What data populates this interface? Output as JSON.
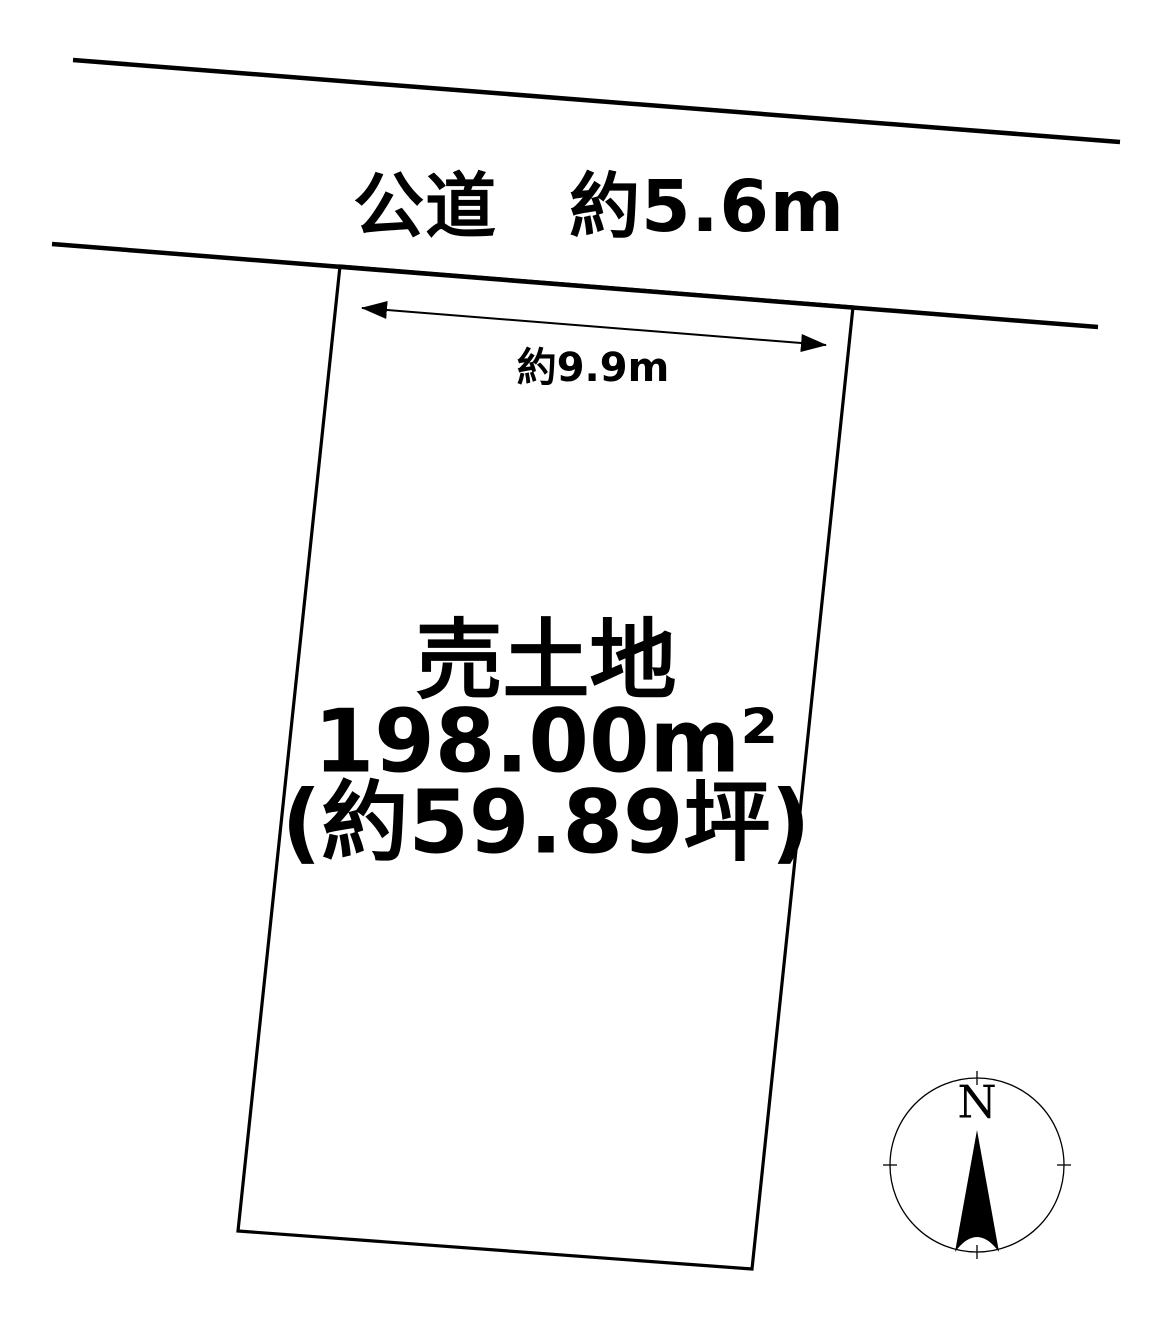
{
  "colors": {
    "ink": "#000000",
    "paper": "#ffffff"
  },
  "road": {
    "label": "公道　約5.6m"
  },
  "frontage_dimension": {
    "label": "約9.9m"
  },
  "parcel": {
    "title": "売土地",
    "area_sqm": "198.00m²",
    "area_tsubo": "(約59.89坪)"
  },
  "compass": {
    "north": "N"
  }
}
